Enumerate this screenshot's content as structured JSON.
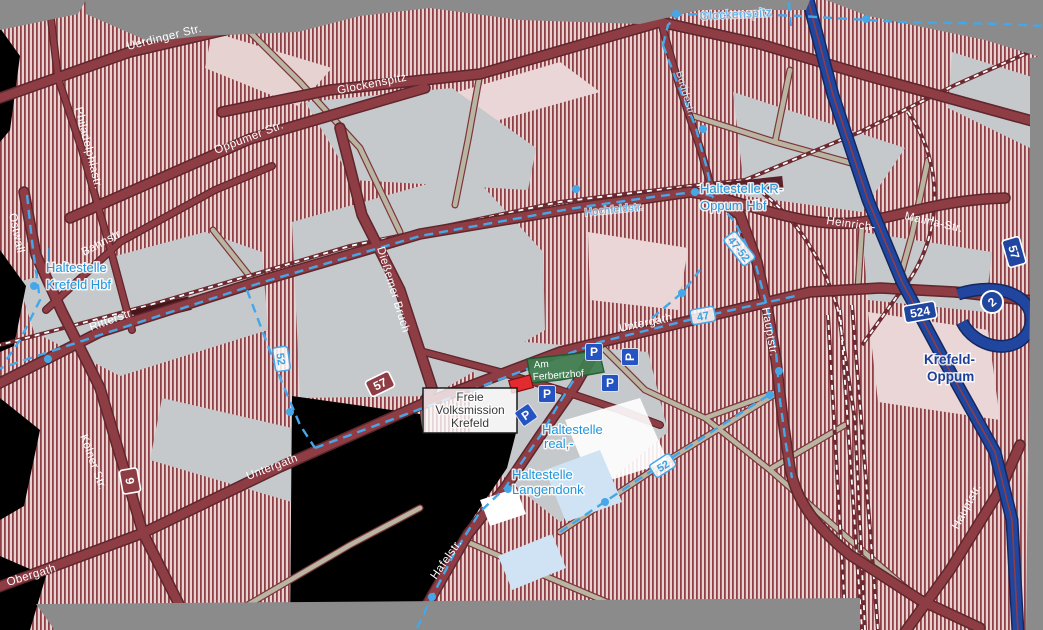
{
  "map": {
    "streets": {
      "uerdinger": "Uerdinger Str.",
      "philadelphiastr": "Philadelphiastr.",
      "ostwall": "Ostwall",
      "oppumer": "Oppumer Str.",
      "glockenspitz": "Glockenspitz",
      "bahnstr": "Bahnstr",
      "ritterstr": "Ritterstr.",
      "diessemer_bruch": "Dießemer Bruch",
      "koelner": "Kölner Str.",
      "obergath": "Obergath",
      "untergath_west": "Untergath",
      "untergath_east": "Untergath",
      "heinrich": "Heinrich-",
      "malina": "Malina-Str.",
      "hauptstr_mid": "Hauptstr.",
      "hauptstr_se": "Hauptstr.",
      "hafelstr": "Hafelstr.",
      "buddestr": "Buddestr.",
      "hochfeldstr": "Hochfeldstr.",
      "glockenspitz_route": "Glockenspitz"
    },
    "transit": {
      "krefeld_hbf_line1": "Haltestelle",
      "krefeld_hbf_line2": "Krefeld Hbf",
      "oppum_line1": "HaltestelleKR-",
      "oppum_line2": "Oppum Hbf",
      "real_line1": "Haltestelle",
      "real_line2": "real,-",
      "langendonk_line1": "Haltestelle",
      "langendonk_line2": "Langendonk",
      "route_47": "47",
      "route_52_west": "52",
      "route_52_east": "52",
      "route_47_52": "47-52"
    },
    "shields": {
      "b9": "9",
      "b57": "57",
      "a57": "57",
      "b524": "524",
      "junction_number": "2"
    },
    "places": {
      "ferbertzhof_line1": "Am",
      "ferbertzhof_line2": "Ferbertzhof",
      "volksmission_line1": "Freie",
      "volksmission_line2": "Volksmission",
      "volksmission_line3": "Krefeld",
      "exit_line1": "Krefeld-",
      "exit_line2": "Oppum"
    },
    "icons": {
      "parking": "P"
    },
    "colors": {
      "road_major": "#8e3d44",
      "road_minor": "#bab5a1",
      "motorway": "#2146a0",
      "bus_route": "#45a7e8",
      "transit_label": "#2196dc",
      "exit_label": "#1e3f99",
      "built_hatch": "#8f4046",
      "built_light": "#e7d2d2",
      "industrial": "#c6c9cc",
      "no_data": "#8b8b8b",
      "green_area_label": "#3f7d4e",
      "poi_marker": "#e32a2e",
      "parking_blue": "#2553c2"
    }
  }
}
